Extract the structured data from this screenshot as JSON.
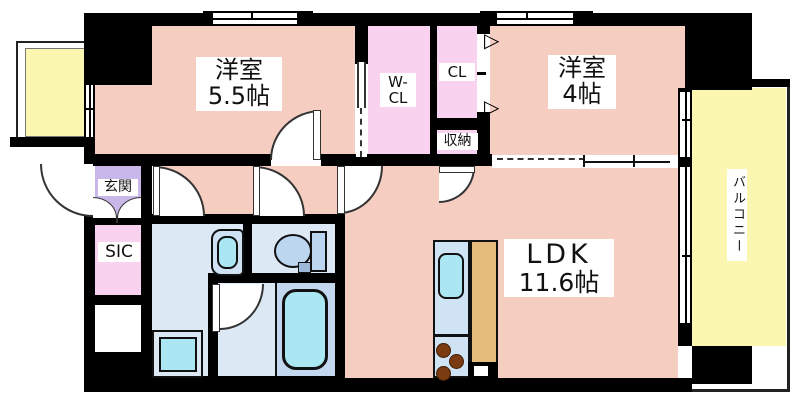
{
  "floorplan": {
    "rooms": {
      "western_room_5_5": {
        "name": "洋室",
        "size": "5.5帖"
      },
      "western_room_4": {
        "name": "洋室",
        "size": "4帖"
      },
      "ldk": {
        "name": "LDK",
        "size": "11.6帖"
      },
      "walk_in_closet": {
        "line1": "W-",
        "line2": "CL"
      },
      "closet": {
        "label": "CL"
      },
      "storage": {
        "label": "収納"
      },
      "entrance": {
        "label": "玄関"
      },
      "shoe_in_closet": {
        "label": "SIC"
      },
      "balcony": {
        "label": "バルコニー"
      }
    },
    "icons": {
      "bifold_door_triangle": "▷"
    },
    "colors": {
      "wall": "#000000",
      "room_floor": "#f6cec1",
      "closet_floor": "#f9d2f0",
      "entrance_floor": "#c9b7e9",
      "sanitary_floor": "#dce9f5",
      "fixture_fill": "#abe7f2",
      "tub_panel": "#c3d8ee",
      "kitchen_counter": "#cfe3f4",
      "kitchen_worktop": "#e5bb7b",
      "stove_burner": "#7a3b10",
      "balcony_floor": "#fbf6b0"
    }
  }
}
